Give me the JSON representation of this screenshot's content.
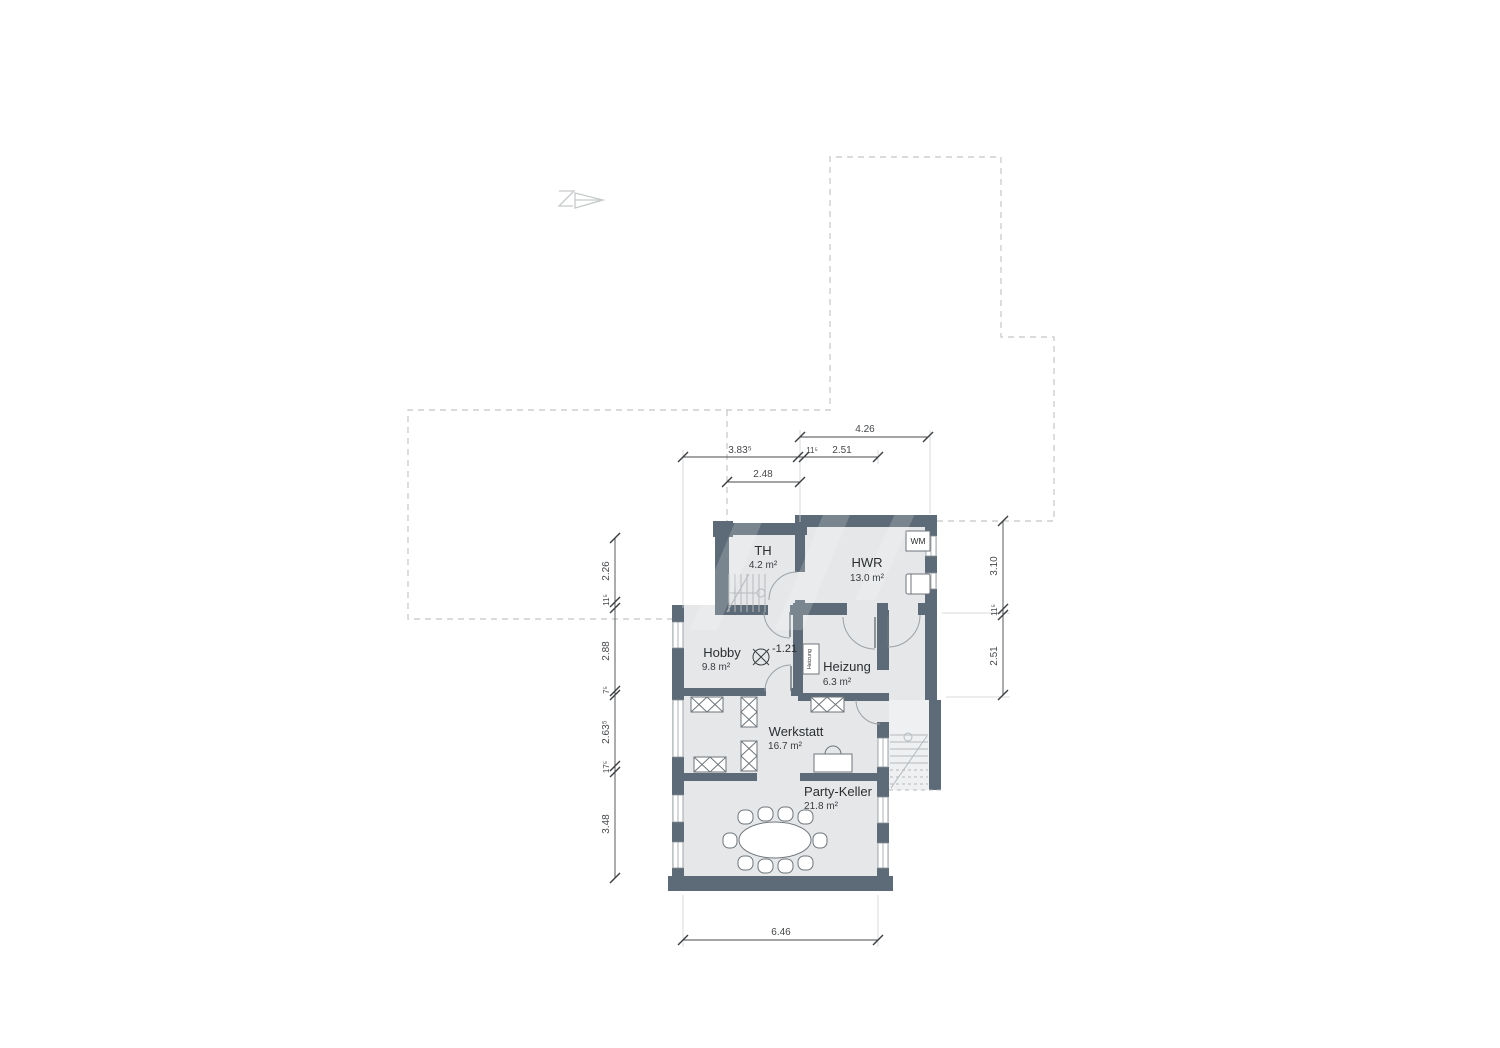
{
  "plan": {
    "title": "Kellergeschoss Grundriss",
    "icons": {
      "north_arrow": "north-arrow"
    },
    "colors": {
      "wall": "#5c6b77",
      "floor": "#e5e7e9",
      "shaft_floor": "#eef0f1",
      "dash_outline": "#c3c6c8",
      "dim_line": "#45484b",
      "furniture_stroke": "#6f767b",
      "stair_line": "#b6babd",
      "door_arc": "#9ba1a5"
    },
    "rooms": {
      "th": {
        "name": "TH",
        "area": "4.2 m²"
      },
      "hwr": {
        "name": "HWR",
        "area": "13.0 m²"
      },
      "hobby": {
        "name": "Hobby",
        "area": "9.8 m²"
      },
      "heizung": {
        "name": "Heizung",
        "area": "6.3 m²"
      },
      "werkstatt": {
        "name": "Werkstatt",
        "area": "16.7 m²"
      },
      "party": {
        "name": "Party-Keller",
        "area": "21.8 m²"
      }
    },
    "fixtures": {
      "washing_machine": "WM",
      "boiler": "Heizung"
    },
    "level_marker": {
      "value": "-1.21"
    },
    "dims": {
      "t1": "4.26",
      "t2": "3.83⁵",
      "t3": "11⁵",
      "t4": "2.51",
      "t5": "2.48",
      "l1": "2.26",
      "l2": "11⁵",
      "l3": "2.88",
      "l4": "7⁵",
      "l5": "2.63⁵",
      "l6": "17⁵",
      "l7": "3.48",
      "r1": "3.10",
      "r2": "11⁵",
      "r3": "2.51",
      "b1": "6.46"
    }
  }
}
